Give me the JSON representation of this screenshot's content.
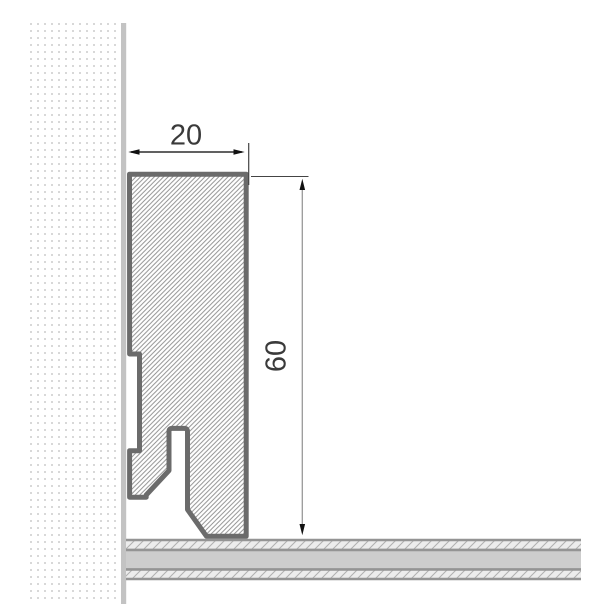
{
  "drawing": {
    "subject": "skirting-board-cross-section",
    "dimensions": {
      "width": {
        "label": "20"
      },
      "height": {
        "label": "60"
      }
    },
    "colors": {
      "background": "#ffffff",
      "profile_outline": "#6b6b6b",
      "profile_hatch_line": "#8e8e8e",
      "wall_dot": "#d8d8d8",
      "wall_surface": "#c3c3c3",
      "floor_solid": "#cdcdcd",
      "floor_border": "#949494",
      "floor_hatch_bg": "#ececec",
      "floor_hatch_line": "#b0b0b0",
      "dimension_text": "#3a3a3a",
      "dimension_line_dark": "#2d2d2d",
      "dimension_line_light": "#999999",
      "extension_line": "#444444",
      "arrowhead": "#111111"
    }
  }
}
